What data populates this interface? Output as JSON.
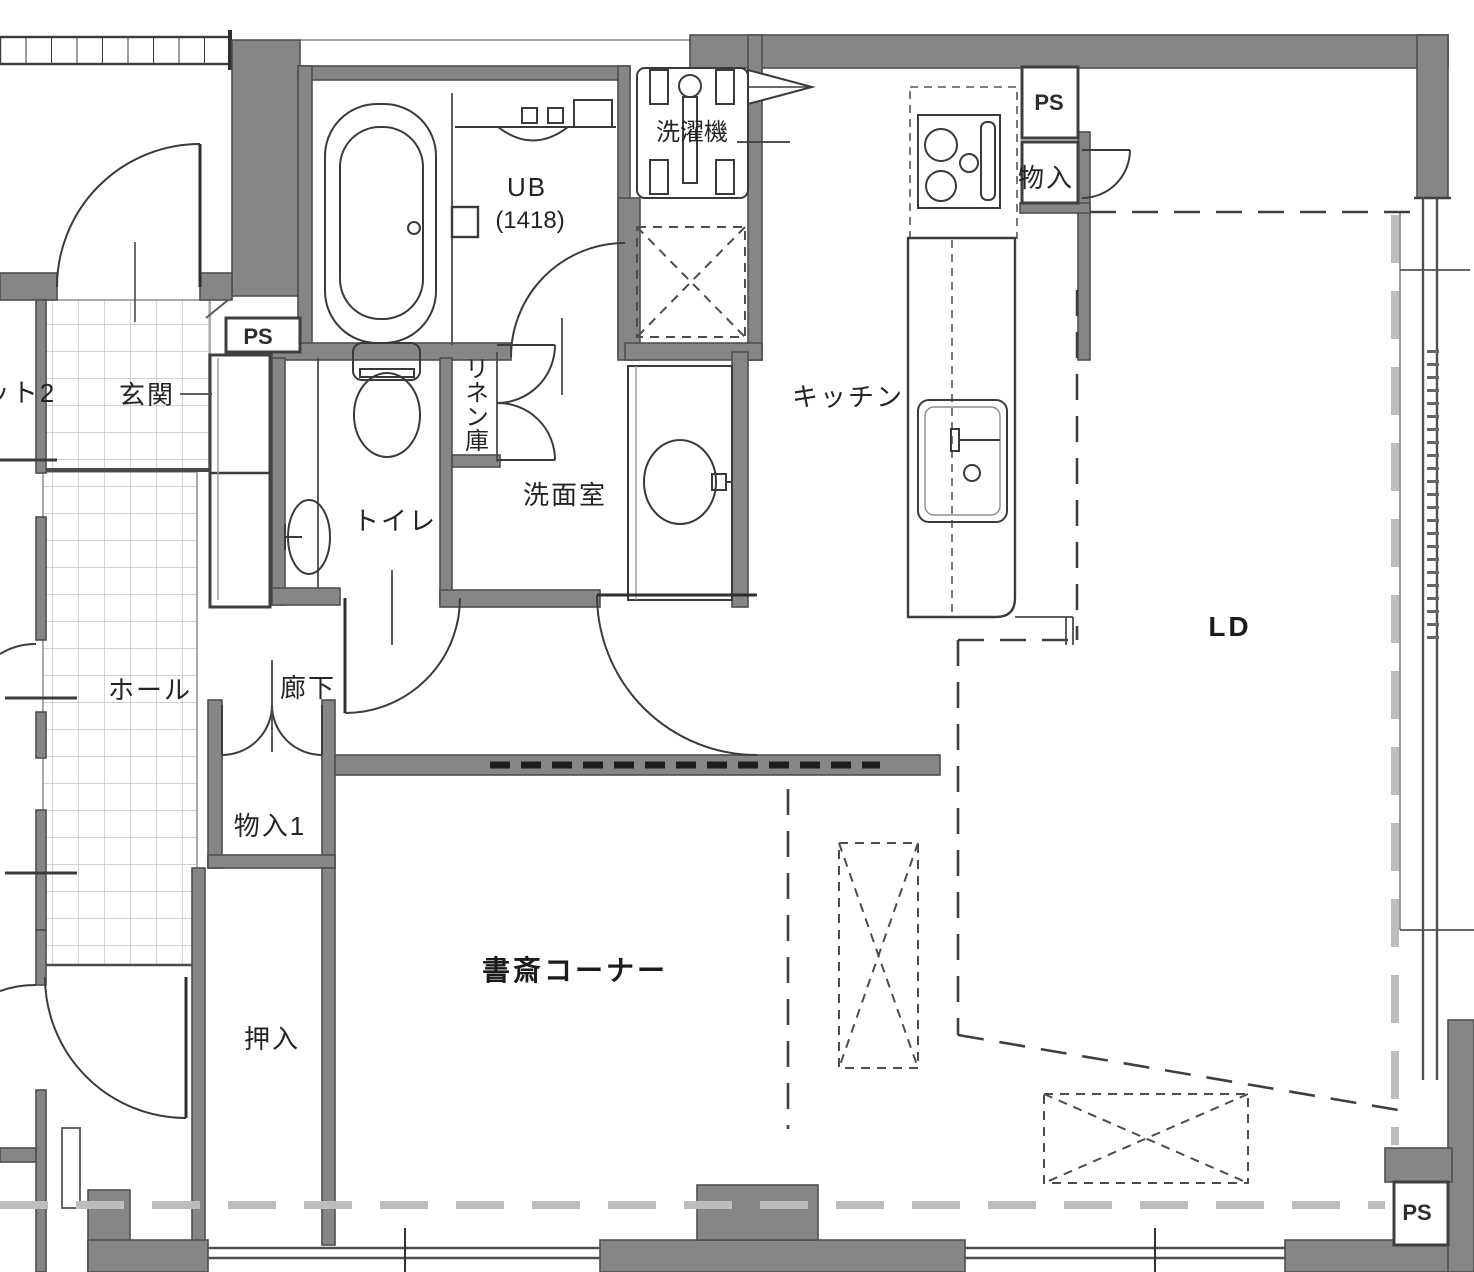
{
  "plan": {
    "rooms": {
      "genkan": {
        "label": "玄関"
      },
      "hall": {
        "label": "ホール"
      },
      "corridor": {
        "label": "廊下"
      },
      "toilet": {
        "label": "トイレ"
      },
      "washroom": {
        "label": "洗面室"
      },
      "linen": {
        "label": "リネン庫"
      },
      "unit_bath": {
        "label": "UB",
        "size": "(1418)"
      },
      "laundry": {
        "label": "洗濯機"
      },
      "kitchen": {
        "label": "キッチン"
      },
      "living_dining": {
        "label": "LD"
      },
      "study": {
        "label": "書斎コーナー"
      },
      "oshiire": {
        "label": "押入"
      },
      "storage1": {
        "label": "物入1"
      },
      "storage_k": {
        "label": "物入"
      },
      "closet2_cut": {
        "label": "ット2"
      },
      "ps": {
        "label": "PS"
      }
    },
    "colors": {
      "wall_fill": "#868686",
      "wall_edge": "#4f4f4f",
      "line": "#3c3c3c",
      "tile_grid": "#c2c2c2",
      "ceiling_dash": "#bdbdbd",
      "background": "#ffffff"
    }
  }
}
